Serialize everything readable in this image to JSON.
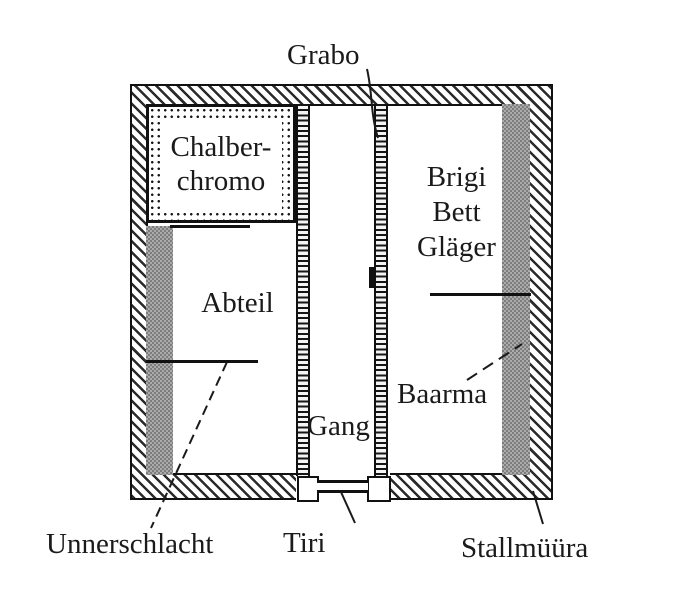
{
  "figure": {
    "title": "stall floor plan",
    "colors": {
      "background": "#ffffff",
      "ink": "#1a1a1a",
      "gray_fill_dark": "#7d7d7d",
      "gray_fill_light": "#ababab"
    },
    "labels": {
      "grabo": "Grabo",
      "chalberchromo": [
        "Chalber-",
        "chromo"
      ],
      "brigi_bett_glaeger": [
        "Brigi",
        "Bett",
        "Gläger"
      ],
      "abteil": "Abteil",
      "gang": "Gang",
      "baarma": "Baarma",
      "unnerschlacht": "Unnerschlacht",
      "tiri": "Tiri",
      "stallmuura": "Stallmüüra"
    }
  }
}
